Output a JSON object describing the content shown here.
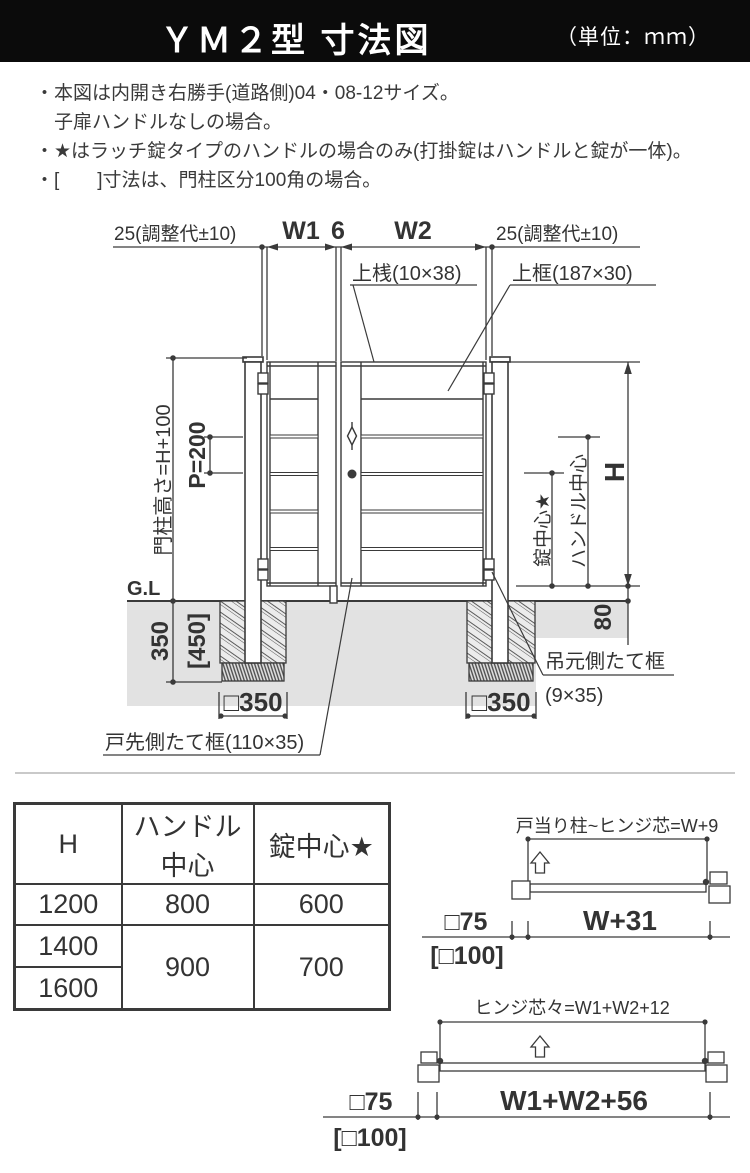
{
  "title": {
    "main": "ＹＭ２型 寸法図",
    "unit": "（単位：ｍｍ）"
  },
  "notes": [
    "・本図は内開き右勝手(道路側)04・08-12サイズ。",
    "　子扉ハンドルなしの場合。",
    "・★はラッチ錠タイプのハンドルの場合のみ(打掛錠はハンドルと錠が一体)。",
    "・[　　]寸法は、門柱区分100角の場合。"
  ],
  "diagram": {
    "adj_left": "25(調整代±10)",
    "w1": "W1",
    "gap6": "6",
    "w2": "W2",
    "adj_right": "25(調整代±10)",
    "top_rail_label": "上桟(10×38)",
    "top_frame_label": "上框(187×30)",
    "post_height": "門柱高さ=H+100",
    "pitch": "P=200",
    "gl": "G.L",
    "depth": "350",
    "depth_alt": "[450]",
    "footing": "□350",
    "lock_center": "錠中心★",
    "handle_center": "ハンドル中心",
    "h": "H",
    "below_80": "80",
    "hinge_stile": "吊元側たて框",
    "hinge_stile_size": "(9×35)",
    "latch_stile": "戸先側たて框(110×35)"
  },
  "table": {
    "col_h": "H",
    "col_handle_1": "ハンドル",
    "col_handle_2": "中心",
    "col_lock": "錠中心★",
    "r1": {
      "h": "1200",
      "handle": "800",
      "lock": "600"
    },
    "r2": {
      "h": "1400"
    },
    "r3": {
      "h": "1600"
    },
    "r23": {
      "handle": "900",
      "lock": "700"
    }
  },
  "sub1": {
    "label": "戸当り柱~ヒンジ芯=W+9",
    "post": "□75",
    "post_alt": "[□100]",
    "width": "W+31"
  },
  "sub2": {
    "label": "ヒンジ芯々=W1+W2+12",
    "post": "□75",
    "post_alt": "[□100]",
    "width": "W1+W2+56"
  }
}
